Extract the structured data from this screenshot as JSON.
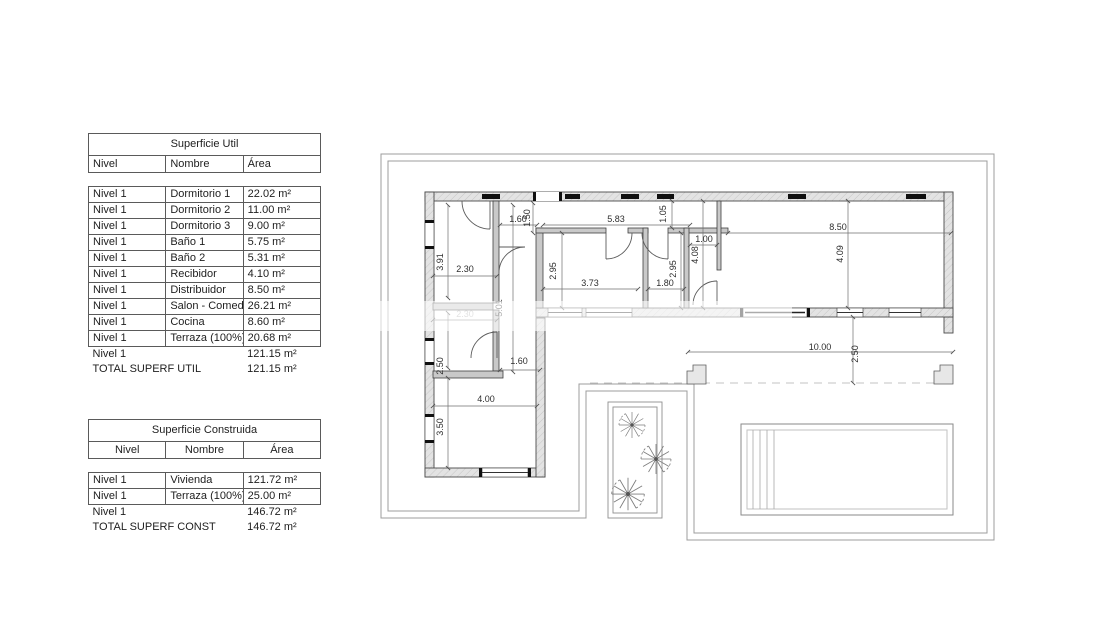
{
  "tables": {
    "util": {
      "title": "Superficie Util",
      "headers": {
        "nivel": "Nivel",
        "nombre": "Nombre",
        "area": "Área"
      },
      "rows": [
        {
          "nivel": "Nivel 1",
          "nombre": "Dormitorio 1",
          "area": "22.02 m²"
        },
        {
          "nivel": "Nivel 1",
          "nombre": "Dormitorio 2",
          "area": "11.00 m²"
        },
        {
          "nivel": "Nivel 1",
          "nombre": "Dormitorio 3",
          "area": "9.00 m²"
        },
        {
          "nivel": "Nivel 1",
          "nombre": "Baño 1",
          "area": "5.75 m²"
        },
        {
          "nivel": "Nivel 1",
          "nombre": "Baño 2",
          "area": "5.31 m²"
        },
        {
          "nivel": "Nivel 1",
          "nombre": "Recibidor",
          "area": "4.10 m²"
        },
        {
          "nivel": "Nivel 1",
          "nombre": "Distribuidor",
          "area": "8.50 m²"
        },
        {
          "nivel": "Nivel 1",
          "nombre": "Salon - Comedor",
          "area": "26.21 m²"
        },
        {
          "nivel": "Nivel 1",
          "nombre": "Cocina",
          "area": "8.60 m²"
        },
        {
          "nivel": "Nivel 1",
          "nombre": "Terraza (100%)",
          "area": "20.68 m²"
        }
      ],
      "subtotal": {
        "nivel": "Nivel 1",
        "area": "121.15 m²"
      },
      "total": {
        "label": "TOTAL SUPERF UTIL",
        "area": "121.15 m²"
      }
    },
    "construida": {
      "title": "Superficie Construida",
      "headers": {
        "nivel": "Nivel",
        "nombre": "Nombre",
        "area": "Área"
      },
      "rows": [
        {
          "nivel": "Nivel 1",
          "nombre": "Vivienda",
          "area": "121.72 m²"
        },
        {
          "nivel": "Nivel 1",
          "nombre": "Terraza (100%)",
          "area": "25.00 m²"
        }
      ],
      "subtotal": {
        "nivel": "Nivel 1",
        "area": "146.72 m²"
      },
      "total": {
        "label": "TOTAL SUPERF CONST",
        "area": "146.72 m²"
      }
    }
  },
  "plan": {
    "dimensions": [
      {
        "label": "1.60",
        "x": 518,
        "y": 222,
        "rot": 0
      },
      {
        "label": "1.50",
        "x": 530,
        "y": 218,
        "rot": -90
      },
      {
        "label": "5.83",
        "x": 616,
        "y": 222,
        "rot": 0
      },
      {
        "label": "1.05",
        "x": 666,
        "y": 214,
        "rot": -90
      },
      {
        "label": "8.50",
        "x": 838,
        "y": 230,
        "rot": 0
      },
      {
        "label": "1.00",
        "x": 704,
        "y": 242,
        "rot": 0
      },
      {
        "label": "4.08",
        "x": 698,
        "y": 255,
        "rot": -90
      },
      {
        "label": "4.09",
        "x": 843,
        "y": 254,
        "rot": -90
      },
      {
        "label": "2.95",
        "x": 556,
        "y": 271,
        "rot": -90
      },
      {
        "label": "3.73",
        "x": 590,
        "y": 286,
        "rot": 0
      },
      {
        "label": "1.80",
        "x": 665,
        "y": 286,
        "rot": 0
      },
      {
        "label": "2.95",
        "x": 676,
        "y": 269,
        "rot": -90
      },
      {
        "label": "3.91",
        "x": 443,
        "y": 262,
        "rot": -90
      },
      {
        "label": "2.30",
        "x": 465,
        "y": 272,
        "rot": 0
      },
      {
        "label": "2.30",
        "x": 465,
        "y": 317,
        "rot": 0,
        "faint": true
      },
      {
        "label": "2.50",
        "x": 443,
        "y": 366,
        "rot": -90
      },
      {
        "label": "5.01",
        "x": 502,
        "y": 308,
        "rot": -90
      },
      {
        "label": "1.60",
        "x": 519,
        "y": 364,
        "rot": 0
      },
      {
        "label": "4.00",
        "x": 486,
        "y": 402,
        "rot": 0
      },
      {
        "label": "3.50",
        "x": 443,
        "y": 427,
        "rot": -90
      },
      {
        "label": "10.00",
        "x": 820,
        "y": 350,
        "rot": 0
      },
      {
        "label": "2.50",
        "x": 858,
        "y": 354,
        "rot": -90
      }
    ]
  }
}
